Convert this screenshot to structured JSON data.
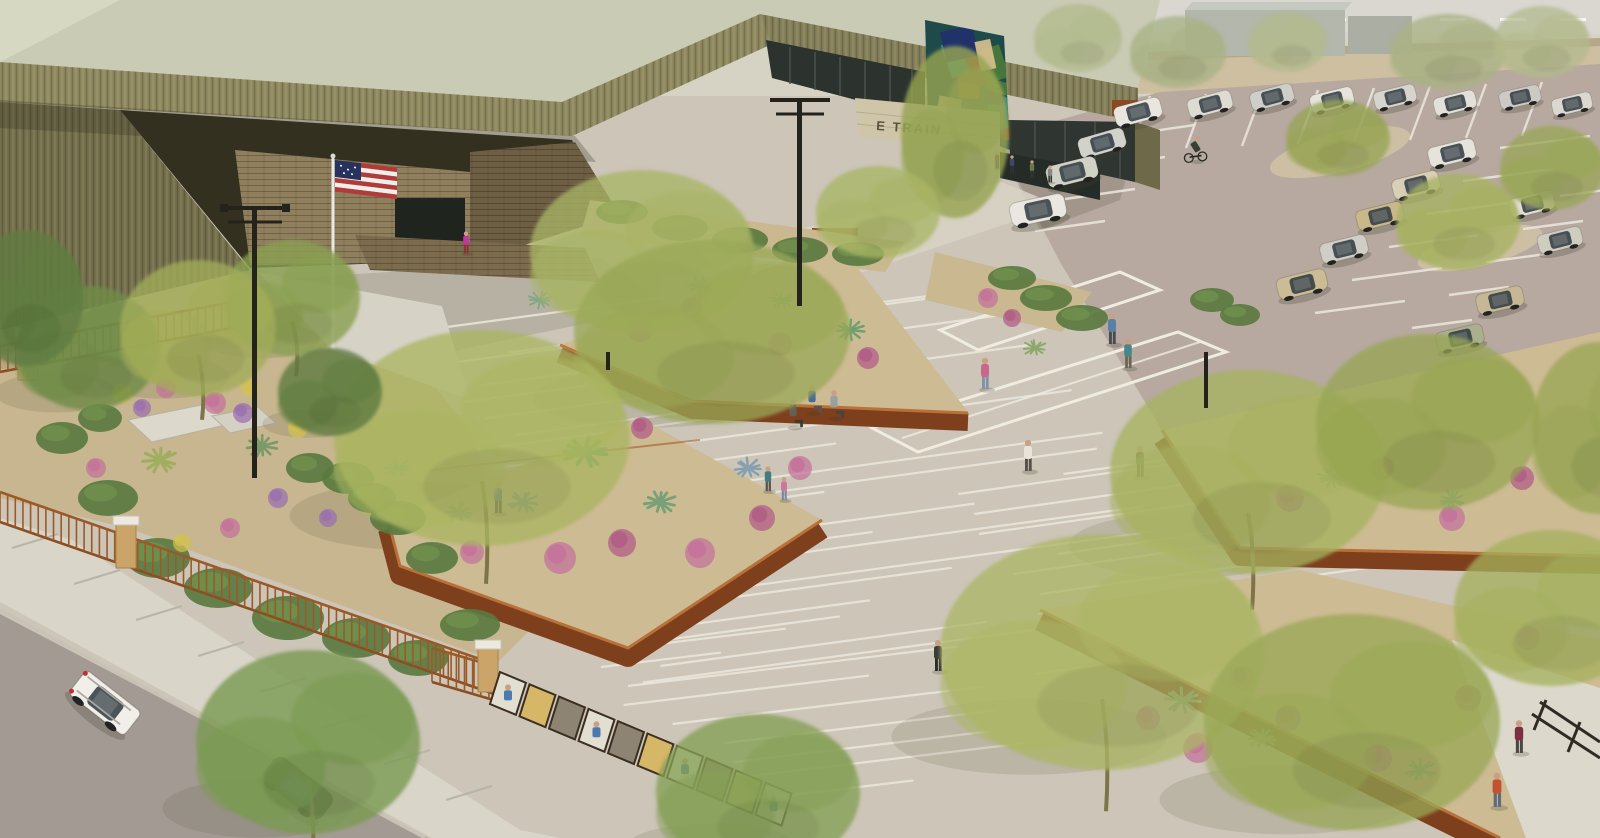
{
  "meta": {
    "description": "Aerial architectural rendering of a single-story civic building with olive-green corrugated metal angled roofs, a desert plaza with striped paving and angular corten-steel planters, a fenced flower garden, a parking lot with cars and a cyclist, an American flag at the entry, and a street with parked cars in the foreground",
    "scene_type": "architectural-rendering",
    "view": "aerial-oblique"
  },
  "signage": {
    "building_sign_text": "E TRAIN",
    "sign_partially_obscured": true
  },
  "palette": {
    "roof_metal": "#8f8a5f",
    "roof_metal_dark": "#75704c",
    "roof_deck": "#c9cbb4",
    "corten_wall": "#7e3f1d",
    "corten_rim": "#b9713a",
    "decomposed_granite": "#cdbb94",
    "plaza_concrete": "#ccc5b8",
    "paving_stripe": "#ece8dd",
    "parking_asphalt": "#b7a99f",
    "street_asphalt": "#a39b93",
    "sidewalk": "#d9d5c9",
    "garden_gravel": "#c7b68f",
    "fence_rust": "#9a5a28",
    "pier_masonry": "#caa469",
    "flag_red": "#b23a3a",
    "flag_blue": "#26335f",
    "brick_tan": "#8f7f5d",
    "mural_base": "#1f4a4a",
    "glass_dark": "#2c332e",
    "skin": "#c9a083"
  },
  "mural_colors": [
    "#d06428",
    "#a83828",
    "#2a8a86",
    "#22306a",
    "#4a7a3a",
    "#d8c090"
  ],
  "entities": {
    "trees": {
      "legend": [
        "x",
        "y",
        "rx",
        "ry",
        "fill",
        "opacity",
        "trunk"
      ],
      "items": [
        [
          955,
          132,
          54,
          86,
          "#96a452",
          0.95,
          0
        ],
        [
          642,
          252,
          112,
          82,
          "#a9b464",
          0.9,
          0
        ],
        [
          712,
          332,
          138,
          92,
          "#9aa855",
          0.88,
          0
        ],
        [
          482,
          438,
          148,
          108,
          "#aab560",
          0.9,
          1
        ],
        [
          292,
          298,
          68,
          58,
          "#8aa050",
          0.95,
          1
        ],
        [
          88,
          348,
          72,
          62,
          "#6f8c48",
          0.95,
          0
        ],
        [
          198,
          328,
          78,
          68,
          "#a2ac58",
          0.92,
          1
        ],
        [
          330,
          392,
          52,
          44,
          "#5f7c40",
          0.95,
          0
        ],
        [
          1248,
          472,
          138,
          102,
          "#a6b25e",
          0.9,
          1
        ],
        [
          1428,
          422,
          112,
          88,
          "#97a552",
          0.88,
          0
        ],
        [
          1102,
          652,
          162,
          118,
          "#abb663",
          0.9,
          1
        ],
        [
          1352,
          722,
          148,
          108,
          "#9aa855",
          0.9,
          0
        ],
        [
          1552,
          608,
          98,
          78,
          "#a4b05c",
          0.88,
          0
        ],
        [
          308,
          742,
          112,
          92,
          "#7a9a50",
          0.95,
          1
        ],
        [
          758,
          792,
          102,
          78,
          "#85a055",
          0.92,
          0
        ],
        [
          1338,
          138,
          52,
          38,
          "#97a454",
          0.9,
          0
        ],
        [
          1458,
          222,
          62,
          48,
          "#a6b260",
          0.9,
          0
        ],
        [
          1552,
          168,
          52,
          42,
          "#99a656",
          0.9,
          0
        ],
        [
          1078,
          38,
          44,
          34,
          "#b2ba8c",
          0.9,
          0
        ],
        [
          1178,
          52,
          48,
          36,
          "#a8b284",
          0.9,
          0
        ],
        [
          1288,
          42,
          40,
          30,
          "#b2ba8c",
          0.85,
          0
        ],
        [
          1448,
          52,
          58,
          38,
          "#aab284",
          0.9,
          0
        ],
        [
          1542,
          42,
          48,
          36,
          "#b2ba8c",
          0.85,
          0
        ],
        [
          26,
          298,
          58,
          68,
          "#5f7c40",
          0.95,
          0
        ],
        [
          878,
          212,
          62,
          46,
          "#a9b464",
          0.9,
          0
        ],
        [
          1598,
          428,
          66,
          86,
          "#97a552",
          0.85,
          0
        ]
      ]
    },
    "parking_cars": {
      "legend": [
        "x",
        "y",
        "rot",
        "color",
        "scale"
      ],
      "items": [
        [
          1138,
          112,
          -15,
          "#e8e6de",
          0.85
        ],
        [
          1210,
          104,
          -15,
          "#dedcd2",
          0.8
        ],
        [
          1272,
          97,
          -15,
          "#cfcfc9",
          0.78
        ],
        [
          1332,
          100,
          -14,
          "#e6e4dc",
          0.78
        ],
        [
          1395,
          97,
          -14,
          "#d6d4cc",
          0.76
        ],
        [
          1455,
          103,
          -14,
          "#e2e0d8",
          0.76
        ],
        [
          1520,
          97,
          -13,
          "#cccac2",
          0.74
        ],
        [
          1572,
          104,
          -13,
          "#dad8d0",
          0.72
        ],
        [
          1102,
          143,
          -16,
          "#d2d2cc",
          0.85
        ],
        [
          1072,
          172,
          -14,
          "#cfd2c4",
          0.92
        ],
        [
          1038,
          210,
          -12,
          "#e9e7df",
          1.0
        ],
        [
          1452,
          153,
          -14,
          "#e6e4da",
          0.85
        ],
        [
          1416,
          185,
          -14,
          "#d9cfb6",
          0.85
        ],
        [
          1380,
          216,
          -14,
          "#c9b98a",
          0.85
        ],
        [
          1344,
          249,
          -14,
          "#cfcfc7",
          0.85
        ],
        [
          1302,
          284,
          -14,
          "#cbbc96",
          0.9
        ],
        [
          1532,
          204,
          -14,
          "#e2ded2",
          0.8
        ],
        [
          1560,
          240,
          -14,
          "#cfccc0",
          0.8
        ],
        [
          1500,
          300,
          -13,
          "#c6b896",
          0.85
        ],
        [
          1460,
          338,
          -13,
          "#aab08e",
          0.85
        ]
      ]
    },
    "street_cars": {
      "legend": [
        "x",
        "y",
        "rot",
        "color",
        "scale",
        "type"
      ],
      "items": [
        [
          105,
          703,
          38,
          "#f1efe7",
          1.25,
          "suv"
        ],
        [
          298,
          788,
          38,
          "#45453b",
          1.3,
          "sedan"
        ]
      ]
    },
    "people": {
      "legend": [
        "x",
        "y",
        "scale",
        "shirt",
        "pants",
        "pose"
      ],
      "items": [
        [
          985,
          370,
          1.0,
          "#c9688e",
          "#8193a8",
          "walk"
        ],
        [
          1112,
          325,
          1.0,
          "#5b80a6",
          "#474b52",
          "walk"
        ],
        [
          1128,
          350,
          0.95,
          "#49868a",
          "#6a6456",
          "walk"
        ],
        [
          1028,
          452,
          1.0,
          "#e7e4da",
          "#57514a",
          "walk"
        ],
        [
          1140,
          458,
          1.0,
          "#6a6f4a",
          "#3f3e38",
          "walk"
        ],
        [
          812,
          396,
          0.9,
          "#4a6a92",
          "#555555",
          "sit"
        ],
        [
          834,
          401,
          0.9,
          "#9aa0a2",
          "#444444",
          "sit"
        ],
        [
          793,
          410,
          0.9,
          "#665f54",
          "#3a3a33",
          "sit"
        ],
        [
          768,
          476,
          0.8,
          "#3f7d80",
          "#5d564b",
          "stand"
        ],
        [
          784,
          486,
          0.75,
          "#c77a9a",
          "#7b88a0",
          "stand"
        ],
        [
          498,
          494,
          1.0,
          "#4a72a4",
          "#3c4048",
          "walk"
        ],
        [
          938,
          652,
          1.0,
          "#3c3c38",
          "#2c2c28",
          "walk"
        ],
        [
          1519,
          733,
          1.05,
          "#7c2f42",
          "#4c4640",
          "walk"
        ],
        [
          1497,
          786,
          1.1,
          "#c25332",
          "#5d6a80",
          "walk"
        ],
        [
          997,
          158,
          0.55,
          "#8a4a3a",
          "#333333",
          "stand"
        ],
        [
          1012,
          162,
          0.55,
          "#3a4a6a",
          "#333333",
          "stand"
        ],
        [
          1032,
          167,
          0.55,
          "#6a7a4a",
          "#333333",
          "stand"
        ],
        [
          1050,
          172,
          0.55,
          "#888888",
          "#333333",
          "stand"
        ],
        [
          466,
          240,
          0.7,
          "#c236a0",
          "#883333",
          "stand"
        ],
        [
          1196,
          146,
          0.8,
          "#3a3f34",
          "#2a2a26",
          "cyclist"
        ]
      ]
    },
    "agaves": {
      "legend": [
        "x",
        "y",
        "scale",
        "color"
      ],
      "items": [
        [
          585,
          452,
          1.7,
          "#6f9f6a"
        ],
        [
          523,
          502,
          1.1,
          "#7aa0a0"
        ],
        [
          458,
          512,
          1.0,
          "#86a886"
        ],
        [
          660,
          502,
          1.2,
          "#79a077"
        ],
        [
          748,
          468,
          1.0,
          "#86a0b0"
        ],
        [
          398,
          468,
          0.9,
          "#7aa08a"
        ],
        [
          700,
          286,
          0.9,
          "#7aa07a"
        ],
        [
          782,
          300,
          0.8,
          "#8aa88a"
        ],
        [
          850,
          330,
          1.0,
          "#6f9f6f"
        ],
        [
          1332,
          478,
          1.0,
          "#7aa07a"
        ],
        [
          1452,
          500,
          0.9,
          "#86a886"
        ],
        [
          1182,
          700,
          1.3,
          "#86b086"
        ],
        [
          1262,
          738,
          1.0,
          "#7aa07a"
        ],
        [
          1420,
          770,
          1.1,
          "#8ab08a"
        ],
        [
          1035,
          348,
          0.8,
          "#8aa86a"
        ],
        [
          160,
          460,
          1.3,
          "#9fae5f"
        ],
        [
          262,
          446,
          1.1,
          "#7a9a6a"
        ],
        [
          540,
          300,
          0.8,
          "#84a884"
        ]
      ]
    },
    "flower_clumps": {
      "legend": [
        "x",
        "y",
        "r",
        "color"
      ],
      "items": [
        [
          560,
          558,
          16,
          "#c4719b"
        ],
        [
          622,
          543,
          14,
          "#b25b86"
        ],
        [
          700,
          553,
          15,
          "#c4719b"
        ],
        [
          762,
          518,
          13,
          "#b25b86"
        ],
        [
          800,
          468,
          12,
          "#c4719b"
        ],
        [
          642,
          428,
          11,
          "#b25b86"
        ],
        [
          472,
          552,
          12,
          "#c4719b"
        ],
        [
          640,
          330,
          12,
          "#c4719b"
        ],
        [
          692,
          308,
          11,
          "#b25b86"
        ],
        [
          780,
          344,
          12,
          "#c4719b"
        ],
        [
          868,
          358,
          11,
          "#b25b86"
        ],
        [
          1290,
          498,
          14,
          "#c4719b"
        ],
        [
          1382,
          468,
          12,
          "#b25b86"
        ],
        [
          1452,
          518,
          13,
          "#c4719b"
        ],
        [
          1522,
          478,
          12,
          "#b25b86"
        ],
        [
          1198,
          748,
          15,
          "#c4719b"
        ],
        [
          1288,
          718,
          13,
          "#b25b86"
        ],
        [
          1378,
          758,
          14,
          "#c4719b"
        ],
        [
          1468,
          698,
          13,
          "#b25b86"
        ],
        [
          1528,
          638,
          12,
          "#c4719b"
        ],
        [
          1242,
          678,
          12,
          "#b25b86"
        ],
        [
          1148,
          718,
          12,
          "#c4719b"
        ],
        [
          988,
          298,
          10,
          "#c4719b"
        ],
        [
          1012,
          318,
          9,
          "#b25b86"
        ],
        [
          215,
          403,
          11,
          "#c4719b"
        ],
        [
          243,
          413,
          10,
          "#9a6fae"
        ],
        [
          122,
          393,
          10,
          "#d2c052"
        ],
        [
          166,
          388,
          10,
          "#c4719b"
        ],
        [
          298,
          428,
          10,
          "#d2c052"
        ],
        [
          96,
          468,
          10,
          "#c4719b"
        ],
        [
          278,
          498,
          10,
          "#9a6fae"
        ],
        [
          230,
          528,
          10,
          "#c4719b"
        ],
        [
          328,
          518,
          9,
          "#9a6fae"
        ],
        [
          182,
          543,
          9,
          "#d2c052"
        ],
        [
          250,
          388,
          9,
          "#d2c052"
        ],
        [
          142,
          408,
          9,
          "#9a6fae"
        ]
      ]
    },
    "shrubs": {
      "legend": [
        "x",
        "y",
        "rx",
        "ry"
      ],
      "items": [
        [
          62,
          438,
          26,
          16
        ],
        [
          108,
          498,
          30,
          18
        ],
        [
          158,
          558,
          32,
          20
        ],
        [
          218,
          588,
          34,
          20
        ],
        [
          288,
          618,
          36,
          22
        ],
        [
          356,
          638,
          34,
          20
        ],
        [
          418,
          658,
          30,
          18
        ],
        [
          100,
          418,
          22,
          14
        ],
        [
          348,
          478,
          26,
          16
        ],
        [
          398,
          518,
          28,
          17
        ],
        [
          432,
          558,
          26,
          16
        ],
        [
          310,
          468,
          24,
          15
        ],
        [
          372,
          498,
          24,
          15
        ],
        [
          622,
          212,
          26,
          12
        ],
        [
          680,
          228,
          28,
          13
        ],
        [
          740,
          240,
          28,
          13
        ],
        [
          800,
          250,
          28,
          13
        ],
        [
          858,
          254,
          26,
          12
        ],
        [
          1012,
          278,
          24,
          12
        ],
        [
          1046,
          298,
          26,
          13
        ],
        [
          1082,
          318,
          26,
          13
        ],
        [
          1212,
          300,
          22,
          12
        ],
        [
          1240,
          315,
          20,
          11
        ],
        [
          470,
          625,
          30,
          16
        ]
      ]
    },
    "fence_runs": [
      [
        0,
        346,
        253,
        298,
        26
      ],
      [
        0,
        492,
        497,
        665,
        30
      ],
      [
        432,
        648,
        497,
        667,
        34
      ]
    ],
    "fence_piers": [
      [
        28,
        336
      ],
      [
        246,
        288
      ],
      [
        126,
        524
      ],
      [
        488,
        648
      ]
    ],
    "display_fence_panels": [
      "photo",
      "amber",
      "mesh",
      "photo",
      "mesh",
      "amber",
      "photo",
      "mesh",
      "amber",
      "photo"
    ],
    "stall_line_fans": [
      {
        "x0": 1150,
        "y0": 96,
        "dx": 56,
        "dy": -2,
        "vx": -20,
        "vy": 54,
        "n": 8
      },
      {
        "x0": 1500,
        "y0": 148,
        "dx": -37,
        "dy": 33,
        "vx": 90,
        "vy": -12,
        "n": 6
      },
      {
        "x0": 1560,
        "y0": 196,
        "dx": -37,
        "dy": 33,
        "vx": 60,
        "vy": -8,
        "n": 5
      },
      {
        "x0": 1125,
        "y0": 135,
        "dx": -30,
        "dy": 32,
        "vx": 70,
        "vy": -10,
        "n": 4
      }
    ],
    "paving_bands": [
      {
        "rows": 22,
        "y0": 336,
        "dy": 16.5,
        "xbase": 380,
        "xdrift": 0.55,
        "xjit": 130,
        "lmin": 200,
        "lvar": 520,
        "xmaxbase": 1020,
        "xmaxdrift": 0.5,
        "tilt": -0.135
      },
      {
        "rows": 9,
        "y0": 648,
        "dy": 19,
        "xbase": 560,
        "xdrift": 0.8,
        "xjit": 90,
        "lmin": 120,
        "lvar": 300,
        "xmaxbase": 930,
        "xmaxdrift": 0.7,
        "tilt": -0.12
      },
      {
        "rows": 11,
        "y0": 474,
        "dy": 20,
        "xbase": 950,
        "xdrift": 0.3,
        "xjit": 140,
        "lmin": 160,
        "lvar": 330,
        "xmaxbase": 1540,
        "xmaxdrift": -0.2,
        "tilt": -0.14
      }
    ],
    "counts": {
      "parked_cars": 20,
      "street_cars": 2,
      "people": 20,
      "trees": 26
    }
  }
}
